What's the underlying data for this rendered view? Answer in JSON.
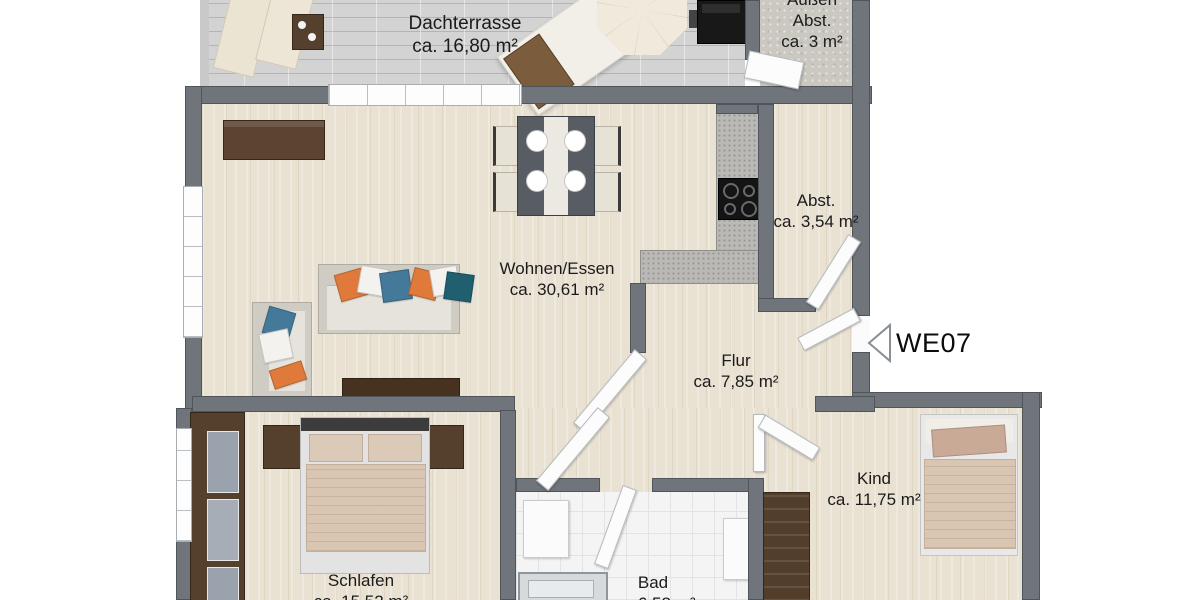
{
  "floorplan": {
    "unit": {
      "code": "WE07"
    },
    "rooms": [
      {
        "id": "dachterrasse",
        "name": "Dachterrasse",
        "area": "ca. 16,80 m²"
      },
      {
        "id": "aussen_abstellraum",
        "name": "Außen",
        "name2": "Abst.",
        "area": "ca. 3 m²"
      },
      {
        "id": "abstellraum",
        "name": "Abst.",
        "area": "ca. 3,54 m²"
      },
      {
        "id": "wohnen_essen",
        "name": "Wohnen/Essen",
        "area": "ca. 30,61 m²"
      },
      {
        "id": "flur",
        "name": "Flur",
        "area": "ca. 7,85 m²"
      },
      {
        "id": "kind",
        "name": "Kind",
        "area": "ca. 11,75 m²"
      },
      {
        "id": "schlafen",
        "name": "Schlafen",
        "area": "ca. 15,52 m²"
      },
      {
        "id": "bad",
        "name": "Bad",
        "area": "ca. 6,58 m²"
      }
    ],
    "colors": {
      "wall": "#70757c",
      "wood_floor": "#e9e2d3",
      "terrace_tile": "#d3d3d3",
      "bath_tile": "#f4f4f4",
      "pillow_orange": "#e07a3a",
      "pillow_steel_blue": "#44799a",
      "pillow_teal": "#1f5f70",
      "dark_furniture_wood": "#54402d",
      "bedding_beige": "#d9c6b2"
    }
  }
}
